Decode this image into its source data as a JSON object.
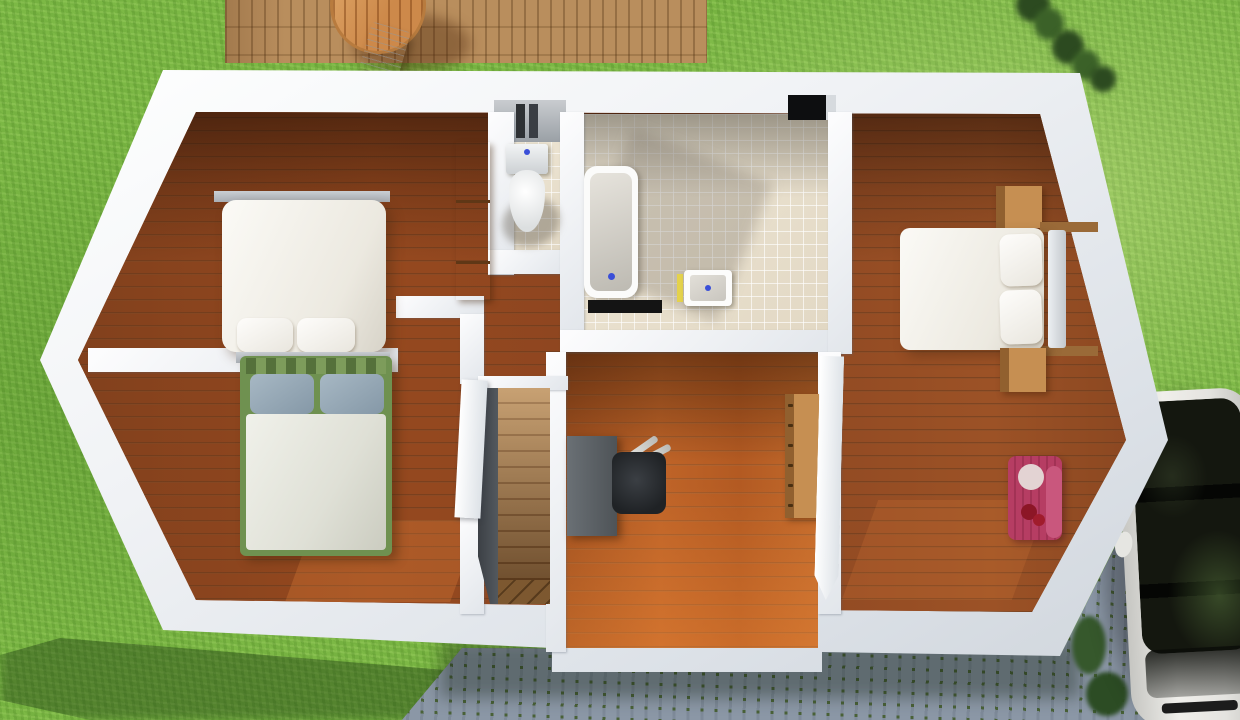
{
  "scene": {
    "type": "3d-floorplan-render",
    "view": "top-down-aerial",
    "floor": "upper-storey",
    "environment": {
      "yard": "grass-lawn",
      "deck": "wooden-terrace",
      "deck_furniture": [
        "round-table",
        "white-chair"
      ],
      "hedge": "bushes-top-right",
      "driveway": "cobblestone-path",
      "vehicle": "white-car-parked",
      "plants": "shrubs-beside-driveway"
    },
    "rooms": [
      {
        "name": "bedroom-top-left",
        "furniture": [
          "double-bed-white",
          "wardrobe"
        ]
      },
      {
        "name": "bedroom-bottom-left",
        "furniture": [
          "double-bed-green-frame"
        ]
      },
      {
        "name": "wc",
        "furniture": [
          "toilet",
          "wall-niche"
        ]
      },
      {
        "name": "bathroom",
        "furniture": [
          "bathtub",
          "bath-mat",
          "sink",
          "vent"
        ]
      },
      {
        "name": "landing-stairwell",
        "furniture": [
          "staircase",
          "doors"
        ]
      },
      {
        "name": "office-middle-room",
        "furniture": [
          "desk",
          "office-chair",
          "drawer-dresser"
        ]
      },
      {
        "name": "bedroom-right",
        "furniture": [
          "double-bed-white",
          "nightstand-top",
          "nightstand-bottom",
          "armchair-pink"
        ]
      }
    ],
    "colors": {
      "grass": "#7cb845",
      "deckWood": "#b98e5d",
      "floorMid": "#91461f",
      "floorOrange": "#b05620",
      "wallWhite": "#f0f2f5",
      "wallShade": "#ccd2d9",
      "tile": "#eae1cf",
      "stairWood": "#b08352",
      "stairDark": "#555b61",
      "deskGray": "#4e5357",
      "chairBlack": "#1f2225",
      "woodFurn": "#c68f52",
      "bedWhite": "#ece9e0",
      "bedGreen": "#6f9150",
      "pillowBlue": "#8598a7",
      "duvet": "#dfe0d6",
      "pinkChair": "#b63d63",
      "carBody": "#f0efeb",
      "carGlass": "#14170f",
      "tailRed": "#c01818",
      "cobble": "#8b97a6",
      "cobbleJoint": "#4a6238",
      "shadow": "rgba(22,48,12,0.38)"
    }
  }
}
